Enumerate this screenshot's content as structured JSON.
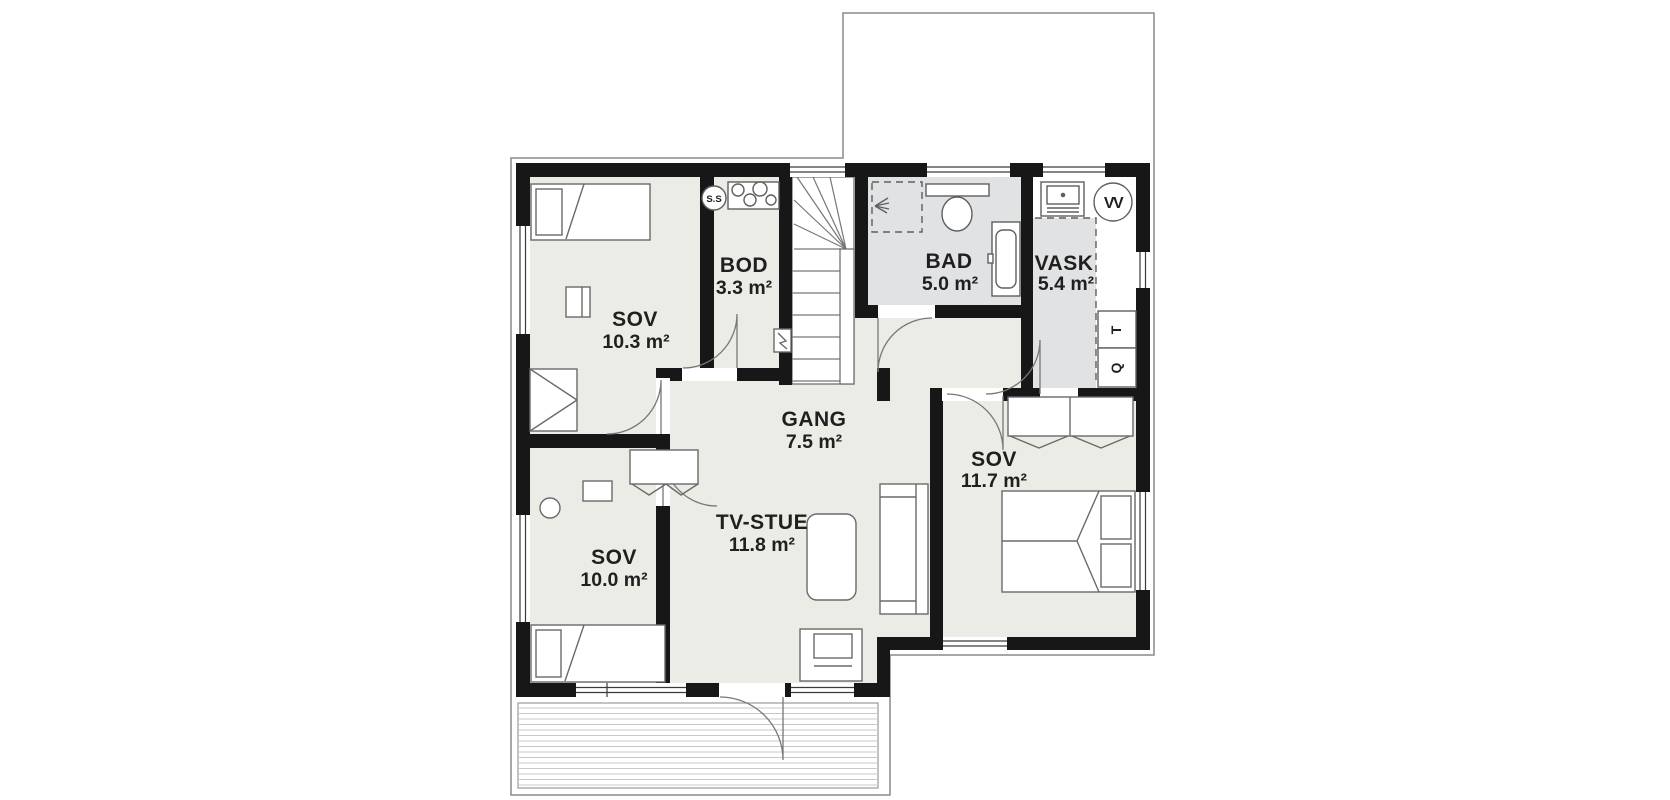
{
  "palette": {
    "wall": "#171717",
    "room_floor": "#ECECE6",
    "wet_floor": "#E1E2E4",
    "furniture_line": "#6a6a6a",
    "outline": "#8a8a8a",
    "deck_line": "#c8c8c8",
    "text": "#1f1f1f"
  },
  "rooms": [
    {
      "name": "SOV",
      "area": "10.3 m²"
    },
    {
      "name": "BOD",
      "area": "3.3 m²"
    },
    {
      "name": "BAD",
      "area": "5.0 m²"
    },
    {
      "name": "VASK",
      "area": "5.4 m²"
    },
    {
      "name": "GANG",
      "area": "7.5 m²"
    },
    {
      "name": "SOV",
      "area": "11.7 m²"
    },
    {
      "name": "TV-STUE",
      "area": "11.8 m²"
    },
    {
      "name": "SOV",
      "area": "10.0 m²"
    }
  ],
  "fixtures": {
    "fuse_box": "S.S",
    "water_heater": "VV",
    "dryer": "T",
    "washing_machine": "Q"
  }
}
